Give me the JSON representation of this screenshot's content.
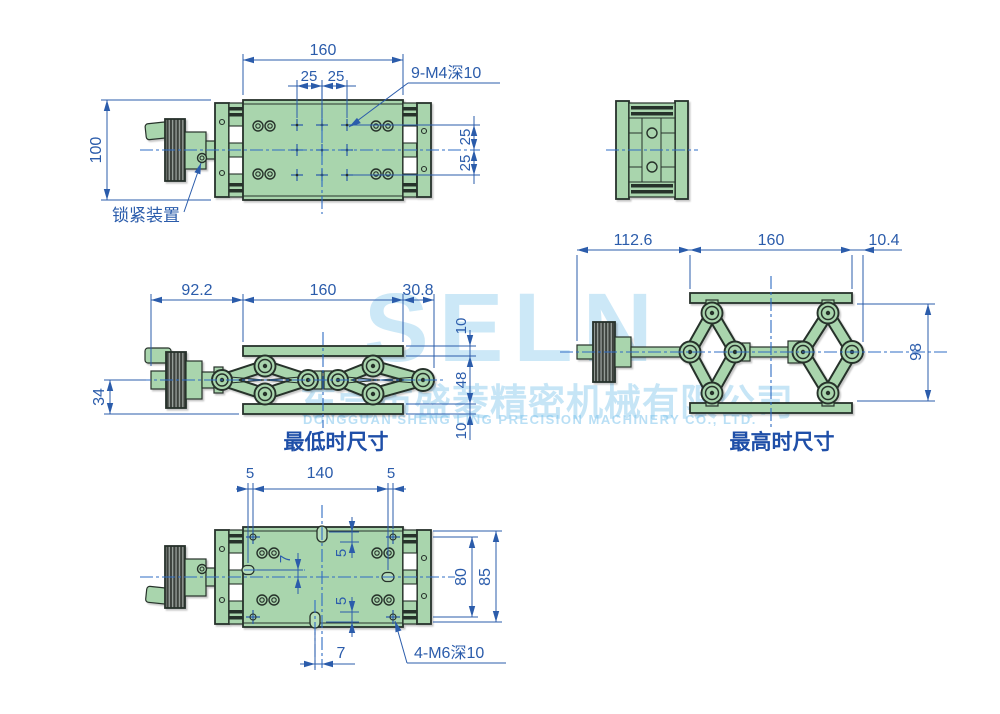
{
  "watermark": {
    "logo": "SELN",
    "company_cn": "东莞市盛菱精密机械有限公司",
    "company_en": "DONGGUAN SHENG LING PRECISION MACHINERY CO., LTD."
  },
  "colors": {
    "part_fill": "#a9d5ad",
    "outline": "#26302a",
    "dimension_blue": "#2b5cab",
    "centerline_blue": "#2f6cc4",
    "watermark_blue": "#80c5ec"
  },
  "views": {
    "top": {
      "dims": {
        "width": "160",
        "pitch_left": "25",
        "pitch_right": "25",
        "depth": "100",
        "pitch_top": "25",
        "pitch_bottom": "25"
      },
      "callouts": {
        "thread": "9-M4深10",
        "lock": "锁紧装置"
      }
    },
    "lowest": {
      "caption": "最低时尺寸",
      "dims": {
        "left": "92.2",
        "middle": "160",
        "right": "30.8",
        "axis_to_bottom": "34",
        "top_plate": "10",
        "body": "48",
        "bottom_plate": "10"
      }
    },
    "highest": {
      "caption": "最高时尺寸",
      "dims": {
        "left": "112.6",
        "middle": "160",
        "right": "10.4",
        "height": "98"
      }
    },
    "bottom": {
      "dims": {
        "edge_left": "5",
        "pitch_x": "140",
        "edge_right": "5",
        "slot_offset_y": "7",
        "slot_top": "5",
        "slot_bottom": "5",
        "pitch_y": "80",
        "span_y": "85",
        "slot_offset_x": "7"
      },
      "callouts": {
        "thread": "4-M6深10"
      }
    }
  }
}
